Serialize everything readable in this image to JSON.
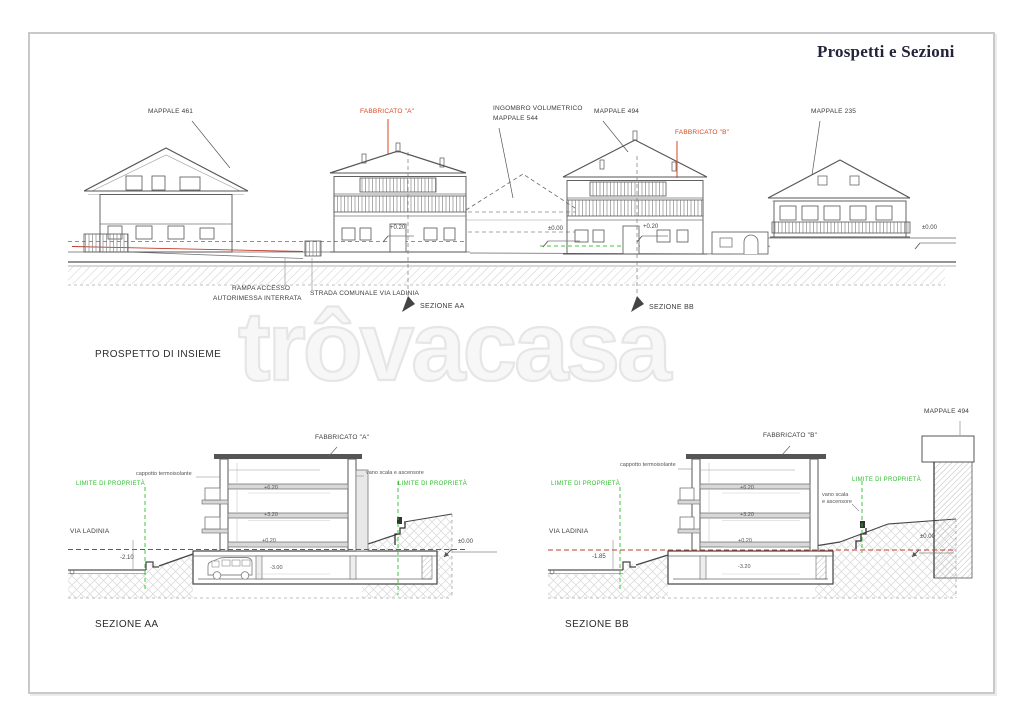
{
  "page": {
    "title": "Prospetti e Sezioni"
  },
  "watermark": {
    "text": "trôvacasa"
  },
  "colors": {
    "accent_red": "#d9441f",
    "limit_green": "#2ebf2e",
    "level_red": "#c0392b",
    "line_gray": "#555555"
  },
  "elevation": {
    "caption": "PROSPETTO DI INSIEME",
    "labels": {
      "mappale_461": "MAPPALE 461",
      "fabbricato_a": "FABBRICATO \"A\"",
      "ingombro_1": "INGOMBRO VOLUMETRICO",
      "ingombro_2": "MAPPALE 544",
      "mappale_494": "MAPPALE 494",
      "fabbricato_b": "FABBRICATO \"B\"",
      "mappale_235": "MAPPALE 235",
      "rampa_1": "RAMPA ACCESSO",
      "rampa_2": "AUTORIMESSA INTERRATA",
      "strada": "STRADA COMUNALE VIA LADINIA",
      "sezione_aa_marker": "SEZIONE AA",
      "sezione_bb_marker": "SEZIONE BB",
      "quota_a_020": "+0.20",
      "quota_b_000": "±0.00",
      "quota_b_020": "+0.20",
      "quota_right_000": "±0.00"
    }
  },
  "sezione_aa": {
    "caption": "SEZIONE AA",
    "labels": {
      "fabbricato": "FABBRICATO \"A\"",
      "cappotto": "cappotto termoisolante",
      "vano_scala": "vano scala e ascensore",
      "limite": "LIMITE DI PROPRIETÀ",
      "via_ladinia": "VIA LADINIA",
      "quota_via": "-2.10",
      "quota_zero": "±0.00",
      "piano_2": "+6.20",
      "piano_1": "+3.20",
      "piano_0": "+0.20",
      "interrato": "-3.00"
    }
  },
  "sezione_bb": {
    "caption": "SEZIONE BB",
    "labels": {
      "fabbricato": "FABBRICATO \"B\"",
      "cappotto": "cappotto termoisolante",
      "vano_scala_1": "vano scala",
      "vano_scala_2": "e ascensore",
      "limite": "LIMITE DI PROPRIETÀ",
      "via_ladinia": "VIA LADINIA",
      "quota_via": "-1.85",
      "quota_zero": "±0.00",
      "piano_2": "+6.20",
      "piano_1": "+3.20",
      "piano_0": "+0.20",
      "interrato": "-3.20",
      "mappale_494": "MAPPALE 494"
    }
  }
}
